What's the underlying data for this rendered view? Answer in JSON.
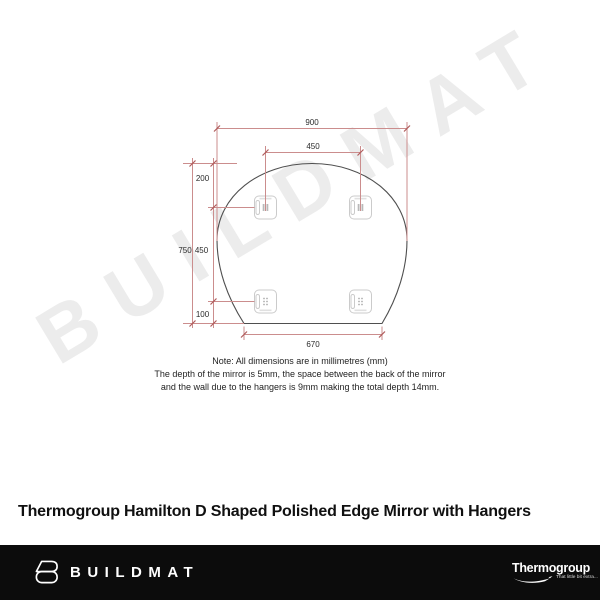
{
  "watermark": "BUILDMAT",
  "title": "Thermogroup Hamilton D Shaped Polished Edge Mirror with Hangers",
  "diagram": {
    "dim_total_width": "900",
    "dim_hanger_spacing": "450",
    "dim_top_to_hanger": "200",
    "dim_total_height": "750",
    "dim_hanger_vertical_spacing": "450",
    "dim_hanger_to_bottom": "100",
    "dim_bottom_width": "670",
    "note_line1": "Note: All dimensions are in millimetres (mm)",
    "note_line2": "The depth of the mirror is 5mm, the space between the back of the mirror",
    "note_line3": "and the wall due to the hangers is 9mm making the total depth 14mm.",
    "colors": {
      "dimension_line": "#cb8d8d",
      "dimension_tick": "#b05c5c",
      "mirror_outline": "#4f4f4f",
      "hanger_outline": "#cbcbcb"
    }
  },
  "footer": {
    "brand": "BUILDMAT",
    "partner_brand": "Thermogroup",
    "partner_tagline": "That little bit extra...",
    "background": "#0c0c0c"
  }
}
